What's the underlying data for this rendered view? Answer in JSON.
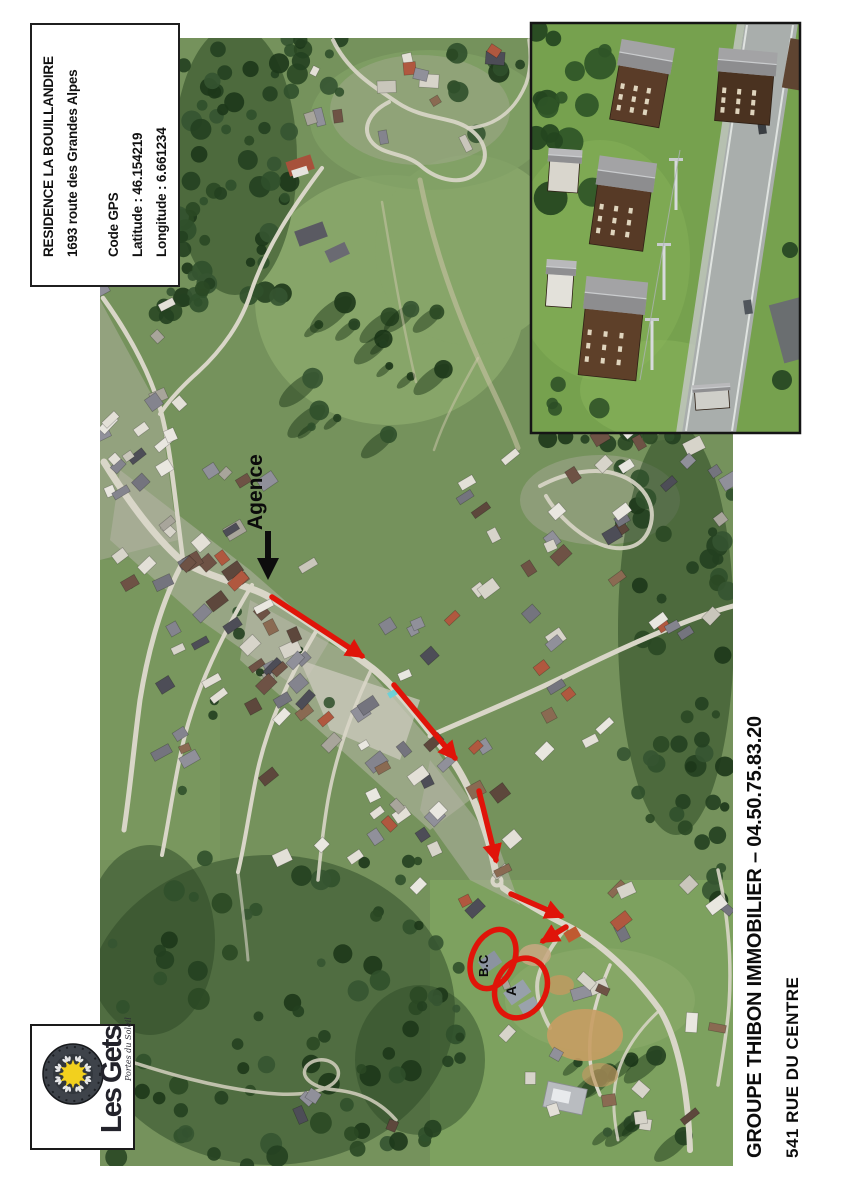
{
  "info_box": {
    "residence_name": "RESIDENCE LA BOUILLANDIRE",
    "address": "1693 route des Grandes Alpes",
    "gps_heading": "Code GPS",
    "latitude": "Latitude : 46.154219",
    "longitude": "Longitude : 6.661234"
  },
  "map": {
    "agence_label": "Agence",
    "marker_bc": "B.C",
    "marker_a": "A"
  },
  "logo": {
    "name": "Les Gets",
    "tagline": "Portes du Soleil"
  },
  "contact": {
    "line1": "GROUPE THIBON IMMOBILIER – 04.50.75.83.20",
    "line2": "541 RUE DU CENTRE"
  },
  "colors": {
    "route_red": "#e01409",
    "arrow_black": "#0d0d0d",
    "meadow_green": "#75925c",
    "forest_green": "#2b4825",
    "road_beige": "#d9d6c8",
    "logo_sun": "#f2d01e",
    "logo_disc": "#3e434a"
  }
}
